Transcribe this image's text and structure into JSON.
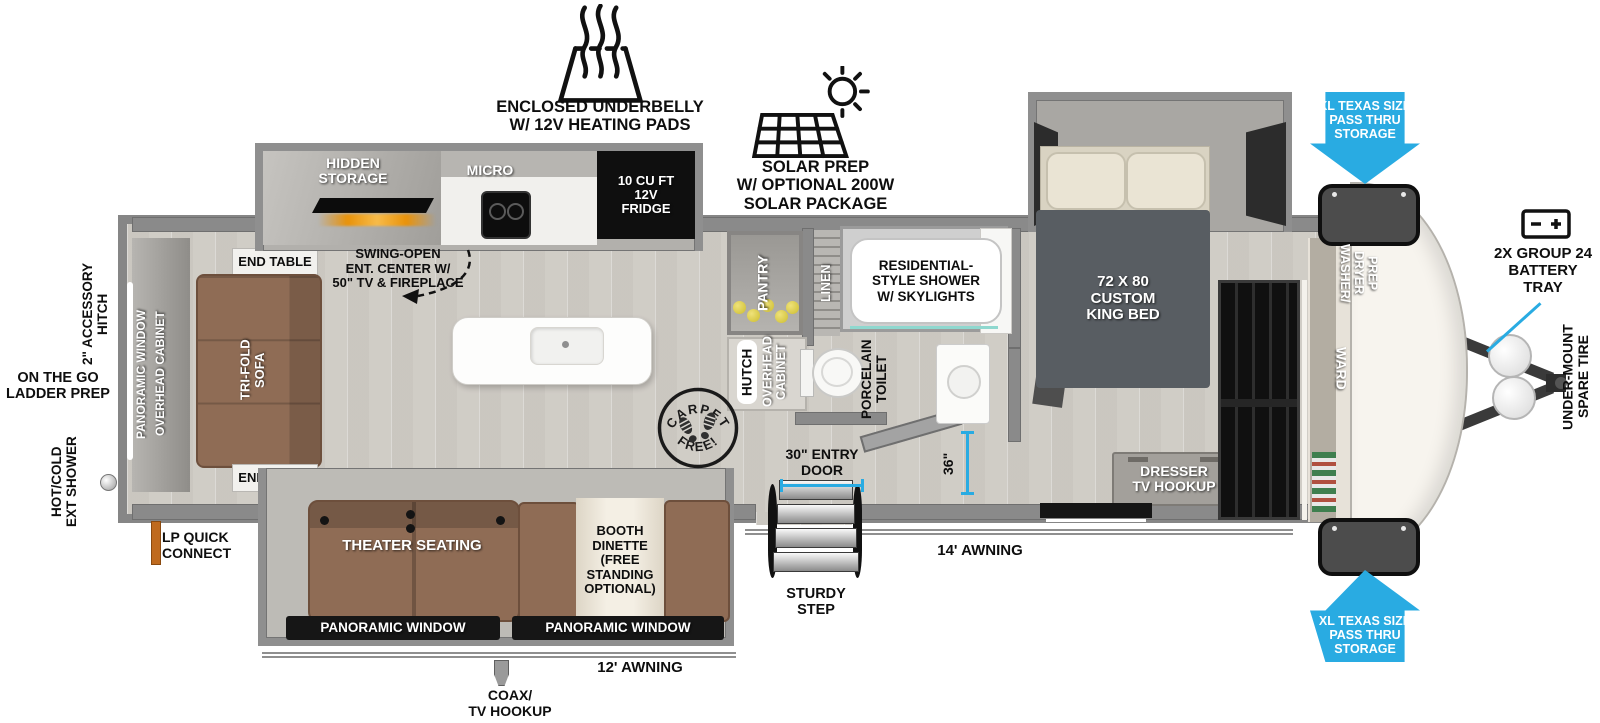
{
  "colors": {
    "accent_blue": "#29abe2",
    "floor": "#d6d3cd",
    "sofa_brown": "#8f6c55",
    "wall_gray": "#8a8a8a"
  },
  "callouts": {
    "underbelly": "ENCLOSED UNDERBELLY\nW/ 12V HEATING PADS",
    "solar": "SOLAR PREP\nW/ OPTIONAL 200W\nSOLAR PACKAGE",
    "pass_thru_top": "XL TEXAS SIZE\nPASS THRU\nSTORAGE",
    "pass_thru_bottom": "XL TEXAS SIZE\nPASS THRU\nSTORAGE",
    "battery": "2X GROUP 24\nBATTERY\nTRAY",
    "spare_tire": "UNDER-MOUNT\nSPARE TIRE",
    "accessory_hitch": "2\" ACCESSORY\nHITCH",
    "ladder_prep": "ON THE GO\nLADDER PREP",
    "ext_shower": "HOT/COLD\nEXT SHOWER",
    "lp_quick_connect": "LP QUICK\nCONNECT",
    "coax": "COAX/\nTV HOOKUP",
    "awning_14": "14' AWNING",
    "awning_12": "12' AWNING",
    "entry_door": "30\" ENTRY\nDOOR",
    "sturdy_step": "STURDY\nSTEP",
    "dim_36": "36\"",
    "carpet_free_top": "CARPET",
    "carpet_free_bottom": "FREE!"
  },
  "kitchen": {
    "hidden_storage": "HIDDEN\nSTORAGE",
    "micro": "MICRO",
    "fridge": "10 CU FT\n12V\nFRIDGE",
    "ent_center": "SWING-OPEN\nENT. CENTER W/\n50\" TV & FIREPLACE",
    "pantry": "PANTRY",
    "hutch": "HUTCH",
    "overhead_cabinet": "OVERHEAD\nCABINET"
  },
  "bathroom": {
    "linen": "LINEN",
    "shower": "RESIDENTIAL-\nSTYLE SHOWER\nW/ SKYLIGHTS",
    "toilet": "PORCELAIN\nTOILET"
  },
  "bedroom": {
    "king_bed": "72 X 80\nCUSTOM\nKING BED",
    "dresser": "DRESSER\nTV HOOKUP",
    "ward": "WARD",
    "washer_dryer": "WASHER/\nDRYER\nPREP"
  },
  "living": {
    "end_table_top": "END TABLE",
    "end_table_bottom": "END TABLE",
    "tri_fold_sofa": "TRI-FOLD\nSOFA",
    "panoramic_window_rear": "PANORAMIC WINDOW",
    "overhead_cabinet_rear": "OVERHEAD CABINET",
    "theater_seating": "THEATER SEATING",
    "booth_dinette": "BOOTH\nDINETTE\n(FREE\nSTANDING\nOPTIONAL)",
    "panoramic_window_left": "PANORAMIC WINDOW",
    "panoramic_window_right": "PANORAMIC WINDOW"
  }
}
